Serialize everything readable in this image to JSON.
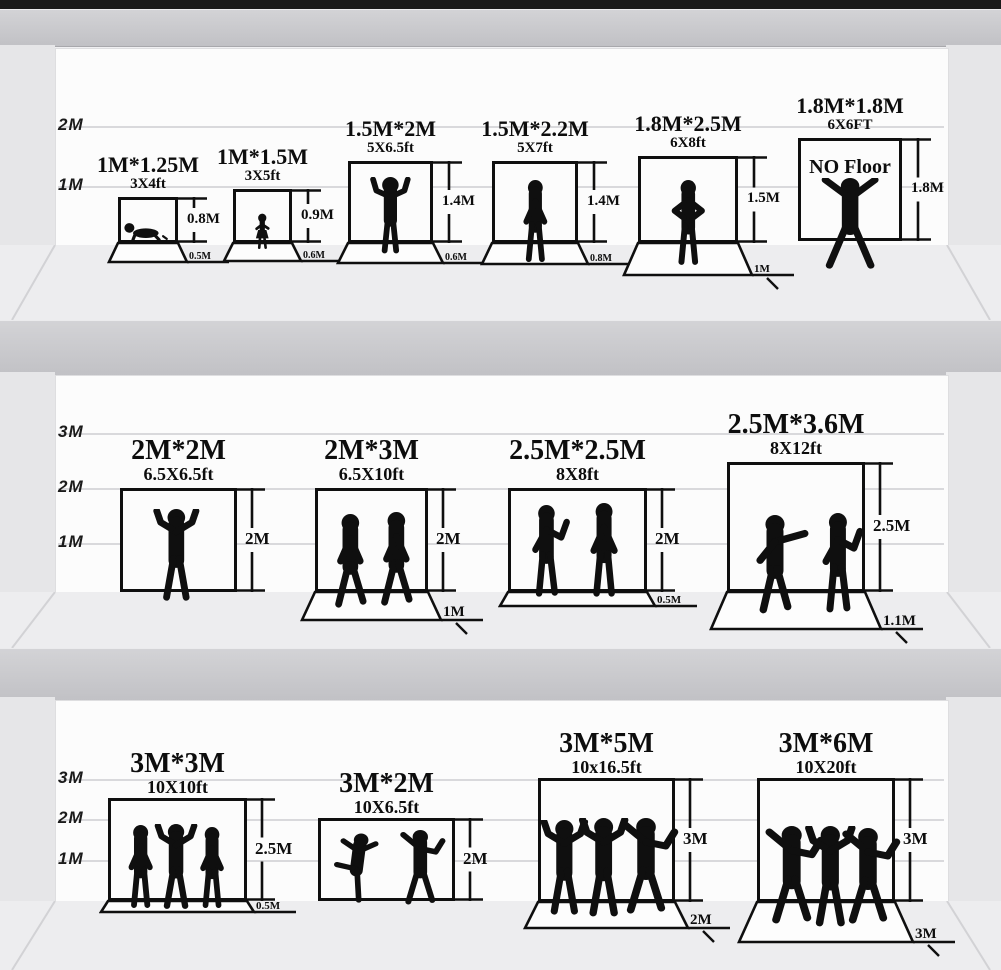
{
  "title": "Photography backdrop size comparison",
  "colors": {
    "ink": "#0f0f0f",
    "wall": "#fcfcfc",
    "floor": "#ededef",
    "divider_band": "#c8c8cc",
    "side_panel": "#e6e6e8",
    "ruler_line": "#d9d9dc",
    "top_bar": "#1a1a1a"
  },
  "shelves": [
    {
      "axis_labels": [
        "2M",
        "1M"
      ],
      "items": [
        {
          "title": "1M*1.25M",
          "subtitle": "3X4ft",
          "height_label": "0.8M",
          "floor_label": "0.5M",
          "figures": [
            "crawling-baby-icon"
          ]
        },
        {
          "title": "1M*1.5M",
          "subtitle": "3X5ft",
          "height_label": "0.9M",
          "floor_label": "0.6M",
          "figures": [
            "toddler-icon"
          ]
        },
        {
          "title": "1.5M*2M",
          "subtitle": "5X6.5ft",
          "height_label": "1.4M",
          "floor_label": "0.6M",
          "figures": [
            "child-arms-raised-icon"
          ]
        },
        {
          "title": "1.5M*2.2M",
          "subtitle": "5X7ft",
          "height_label": "1.4M",
          "floor_label": "0.8M",
          "figures": [
            "standing-person-icon"
          ]
        },
        {
          "title": "1.8M*2.5M",
          "subtitle": "6X8ft",
          "height_label": "1.5M",
          "floor_label": "1M",
          "figures": [
            "hands-on-hips-person-icon"
          ]
        },
        {
          "title": "1.8M*1.8M",
          "subtitle": "6X6FT",
          "height_label": "1.8M",
          "inner_label": "NO Floor",
          "figures": [
            "arms-spread-person-icon"
          ]
        }
      ]
    },
    {
      "axis_labels": [
        "3M",
        "2M",
        "1M"
      ],
      "items": [
        {
          "title": "2M*2M",
          "subtitle": "6.5X6.5ft",
          "height_label": "2M",
          "figures": [
            "arms-up-person-icon"
          ]
        },
        {
          "title": "2M*3M",
          "subtitle": "6.5X10ft",
          "height_label": "2M",
          "floor_label": "1M",
          "figures": [
            "walking-person-icon",
            "walking-person-icon"
          ]
        },
        {
          "title": "2.5M*2.5M",
          "subtitle": "8X8ft",
          "height_label": "2M",
          "floor_label": "0.5M",
          "figures": [
            "talking-person-icon",
            "standing-person-icon"
          ]
        },
        {
          "title": "2.5M*3.6M",
          "subtitle": "8X12ft",
          "height_label": "2.5M",
          "floor_label": "1.1M",
          "figures": [
            "pointing-person-icon",
            "talking-person-icon"
          ]
        }
      ]
    },
    {
      "axis_labels": [
        "3M",
        "2M",
        "1M"
      ],
      "items": [
        {
          "title": "3M*3M",
          "subtitle": "10X10ft",
          "height_label": "2.5M",
          "floor_label": "0.5M",
          "figures": [
            "standing-person-icon",
            "arms-up-person-icon",
            "standing-person-icon"
          ]
        },
        {
          "title": "3M*2M",
          "subtitle": "10X6.5ft",
          "height_label": "2M",
          "figures": [
            "kicking-person-icon",
            "dancing-person-icon"
          ]
        },
        {
          "title": "3M*5M",
          "subtitle": "10x16.5ft",
          "height_label": "3M",
          "floor_label": "2M",
          "figures": [
            "arms-up-person-icon",
            "arms-up-person-icon",
            "dancing-person-icon"
          ]
        },
        {
          "title": "3M*6M",
          "subtitle": "10X20ft",
          "height_label": "3M",
          "floor_label": "3M",
          "figures": [
            "dancing-person-icon",
            "arms-up-person-icon",
            "dancing-person-icon"
          ]
        }
      ]
    }
  ]
}
